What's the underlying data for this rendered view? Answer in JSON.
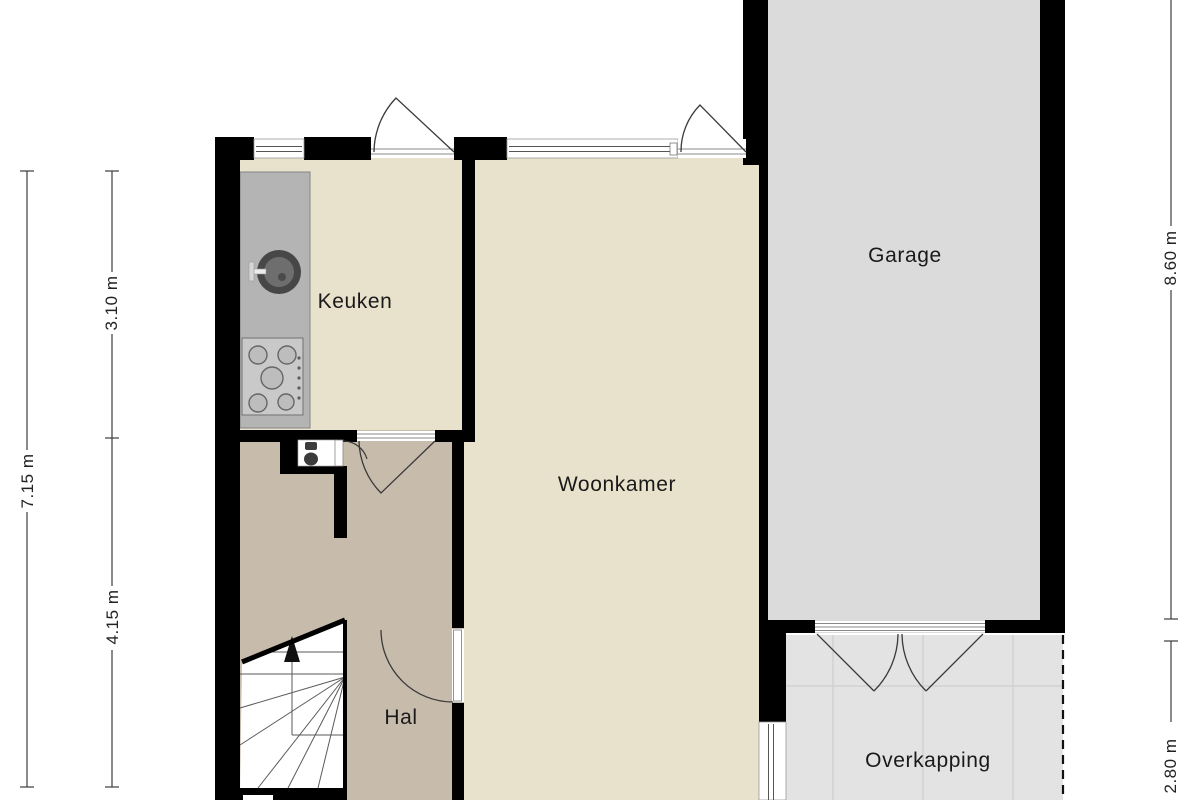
{
  "floorplan": {
    "type": "residential-floorplan-ground-floor",
    "rooms": [
      {
        "id": "keuken",
        "label": "Keuken"
      },
      {
        "id": "woonkamer",
        "label": "Woonkamer"
      },
      {
        "id": "garage",
        "label": "Garage"
      },
      {
        "id": "hal",
        "label": "Hal"
      },
      {
        "id": "overkapping",
        "label": "Overkapping"
      }
    ],
    "dimensions": [
      {
        "id": "left-total",
        "label": "7.15 m"
      },
      {
        "id": "left-upper",
        "label": "3.10 m"
      },
      {
        "id": "left-lower",
        "label": "4.15 m"
      },
      {
        "id": "right-upper",
        "label": "8.60 m"
      },
      {
        "id": "right-lower",
        "label": "2.80 m"
      }
    ],
    "fixtures": [
      "kitchen-counter",
      "kitchen-sink",
      "kitchen-stove",
      "wc-toilet",
      "staircase",
      "stairs-up-arrow",
      "garage-double-door",
      "entry-doors",
      "windows"
    ],
    "colors": {
      "wall": "#000000",
      "living_floor": "#e8e1cb",
      "hall_floor": "#c7bbac",
      "garage_floor": "#dbdbdb",
      "overkapping_floor": "#e3e3e3",
      "counter": "#b4b4b4",
      "background": "#ffffff",
      "dimension_line": "#3c3c3c"
    }
  }
}
